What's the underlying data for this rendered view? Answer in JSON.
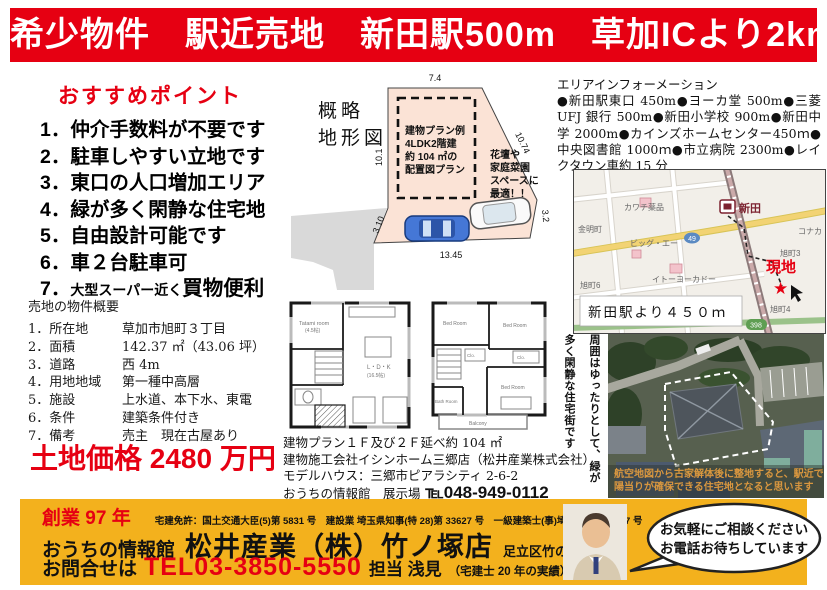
{
  "colors": {
    "red": "#e60012",
    "yellow": "#f3b11d",
    "peach": "#fbe3d6",
    "map_bg": "#f2efe9"
  },
  "banner": {
    "text": "希少物件　駅近売地　新田駅500m　草加ICより2km"
  },
  "points": {
    "title": "おすすめポイント",
    "items": [
      "1．仲介手数料が不要です",
      "2．駐車しやすい立地です",
      "3．東口の人口増加エリア",
      "4．緑が多く閑静な住宅地",
      "5．自由設計可能です",
      "6．車２台駐車可"
    ],
    "item7": {
      "num": "7．",
      "small": "大型スーパー近く",
      "big": "買物便利"
    }
  },
  "overview": {
    "title": "売地の物件概要",
    "rows": [
      {
        "label": "1．所在地",
        "value": "草加市旭町３丁目"
      },
      {
        "label": "2．面積",
        "value": "142.37 ㎡（43.06 坪）"
      },
      {
        "label": "3．道路",
        "value": "西 4m"
      },
      {
        "label": "4．用地地域",
        "value": "第一種中高層"
      },
      {
        "label": "5．施設",
        "value": "上水道、本下水、東電"
      },
      {
        "label": "6．条件",
        "value": "建築条件付き"
      },
      {
        "label": "7．備考",
        "value": "売主　現在古屋あり"
      }
    ],
    "price": "土地価格 2480 万円"
  },
  "diagram": {
    "label": [
      "概略",
      "地形図"
    ],
    "dims": {
      "top": "7.4",
      "left": "10.1",
      "diagonal": "10.74",
      "right": "3.2",
      "bottom": "13.45",
      "lower_left": "3.10"
    },
    "inner_lines": [
      "建物プラン例",
      "4LDK2階建",
      "約 104 ㎡の",
      "配置図プラン"
    ],
    "note_lines": [
      "花壇や",
      "家庭菜園",
      "スペースに",
      "最適！！"
    ]
  },
  "plans": {
    "plan1f": {
      "tatami": "Tatami room",
      "tatami_size": "(4.5帖)",
      "ldk": "L・D・K",
      "ldk_size": "(16.5帖)"
    },
    "plan2f": {
      "bed": "Bed Room",
      "bath": "Bath Room",
      "balcony": "Balcony",
      "clo": "Clo."
    },
    "caption_lines": [
      "建物プラン１Ｆ及び２Ｆ延べ約 104 ㎡",
      "建物施工会社イシンホーム三郷店（松井産業株式会社）",
      "モデルハウス：三郷市ピアラシティ 2-6-2"
    ],
    "caption_tel_label": "おうちの情報館　展示場",
    "caption_tel": "℡048-949-0112"
  },
  "area": {
    "title": "エリアインフォーメーション",
    "body": "●新田駅東口 450m●ヨーカ堂 500m●三菱 UFJ 銀行 500m●新田小学校 900m●新田中学 2000m●カインズホームセンター450ｍ●中央図書館 1000ｍ●市立病院 2300m●レイクタウン車約 15 分"
  },
  "map": {
    "station_label": "新田",
    "site_label": "現地",
    "star": "★",
    "caption": "新田駅より４５０ｍ",
    "labels": {
      "pharmacy": "カワチ薬品",
      "kinmei": "金明町",
      "bigA": "ビッグ・エー",
      "itoyokado": "イトーヨーカドー",
      "konaka": "コナカ",
      "asahi3": "旭町3",
      "asahi6": "旭町6",
      "asahi4": "旭町4",
      "route398": "398",
      "route49": "49"
    }
  },
  "aerial": {
    "side_col1": "周囲はゆったりとして、緑が",
    "side_col2": "多く閑静な住宅街です",
    "caption1": "航空地図から古家解体後に整地すると、駅近でも",
    "caption2": "陽当りが確保できる住宅地となると思います"
  },
  "footer": {
    "founded": "創業 97 年",
    "license": "宅建免許：国土交通大臣(5)第 5831 号　建設業 埼玉県知事(特 28)第 33627 号　一級建築士(事)埼玉県(7)第 1527 号",
    "company1": "おうちの情報館",
    "company2": "松井産業（株）竹ノ塚店",
    "address": "足立区竹の塚 1-37-6",
    "contact_label": "お問合せは",
    "tel": "TEL03-3850-5550",
    "person": "担当 浅見",
    "person_note": "（宅建士 20 年の実績）",
    "bubble_line1": "お気軽にご相談ください",
    "bubble_line2": "お電話お待ちしています"
  }
}
